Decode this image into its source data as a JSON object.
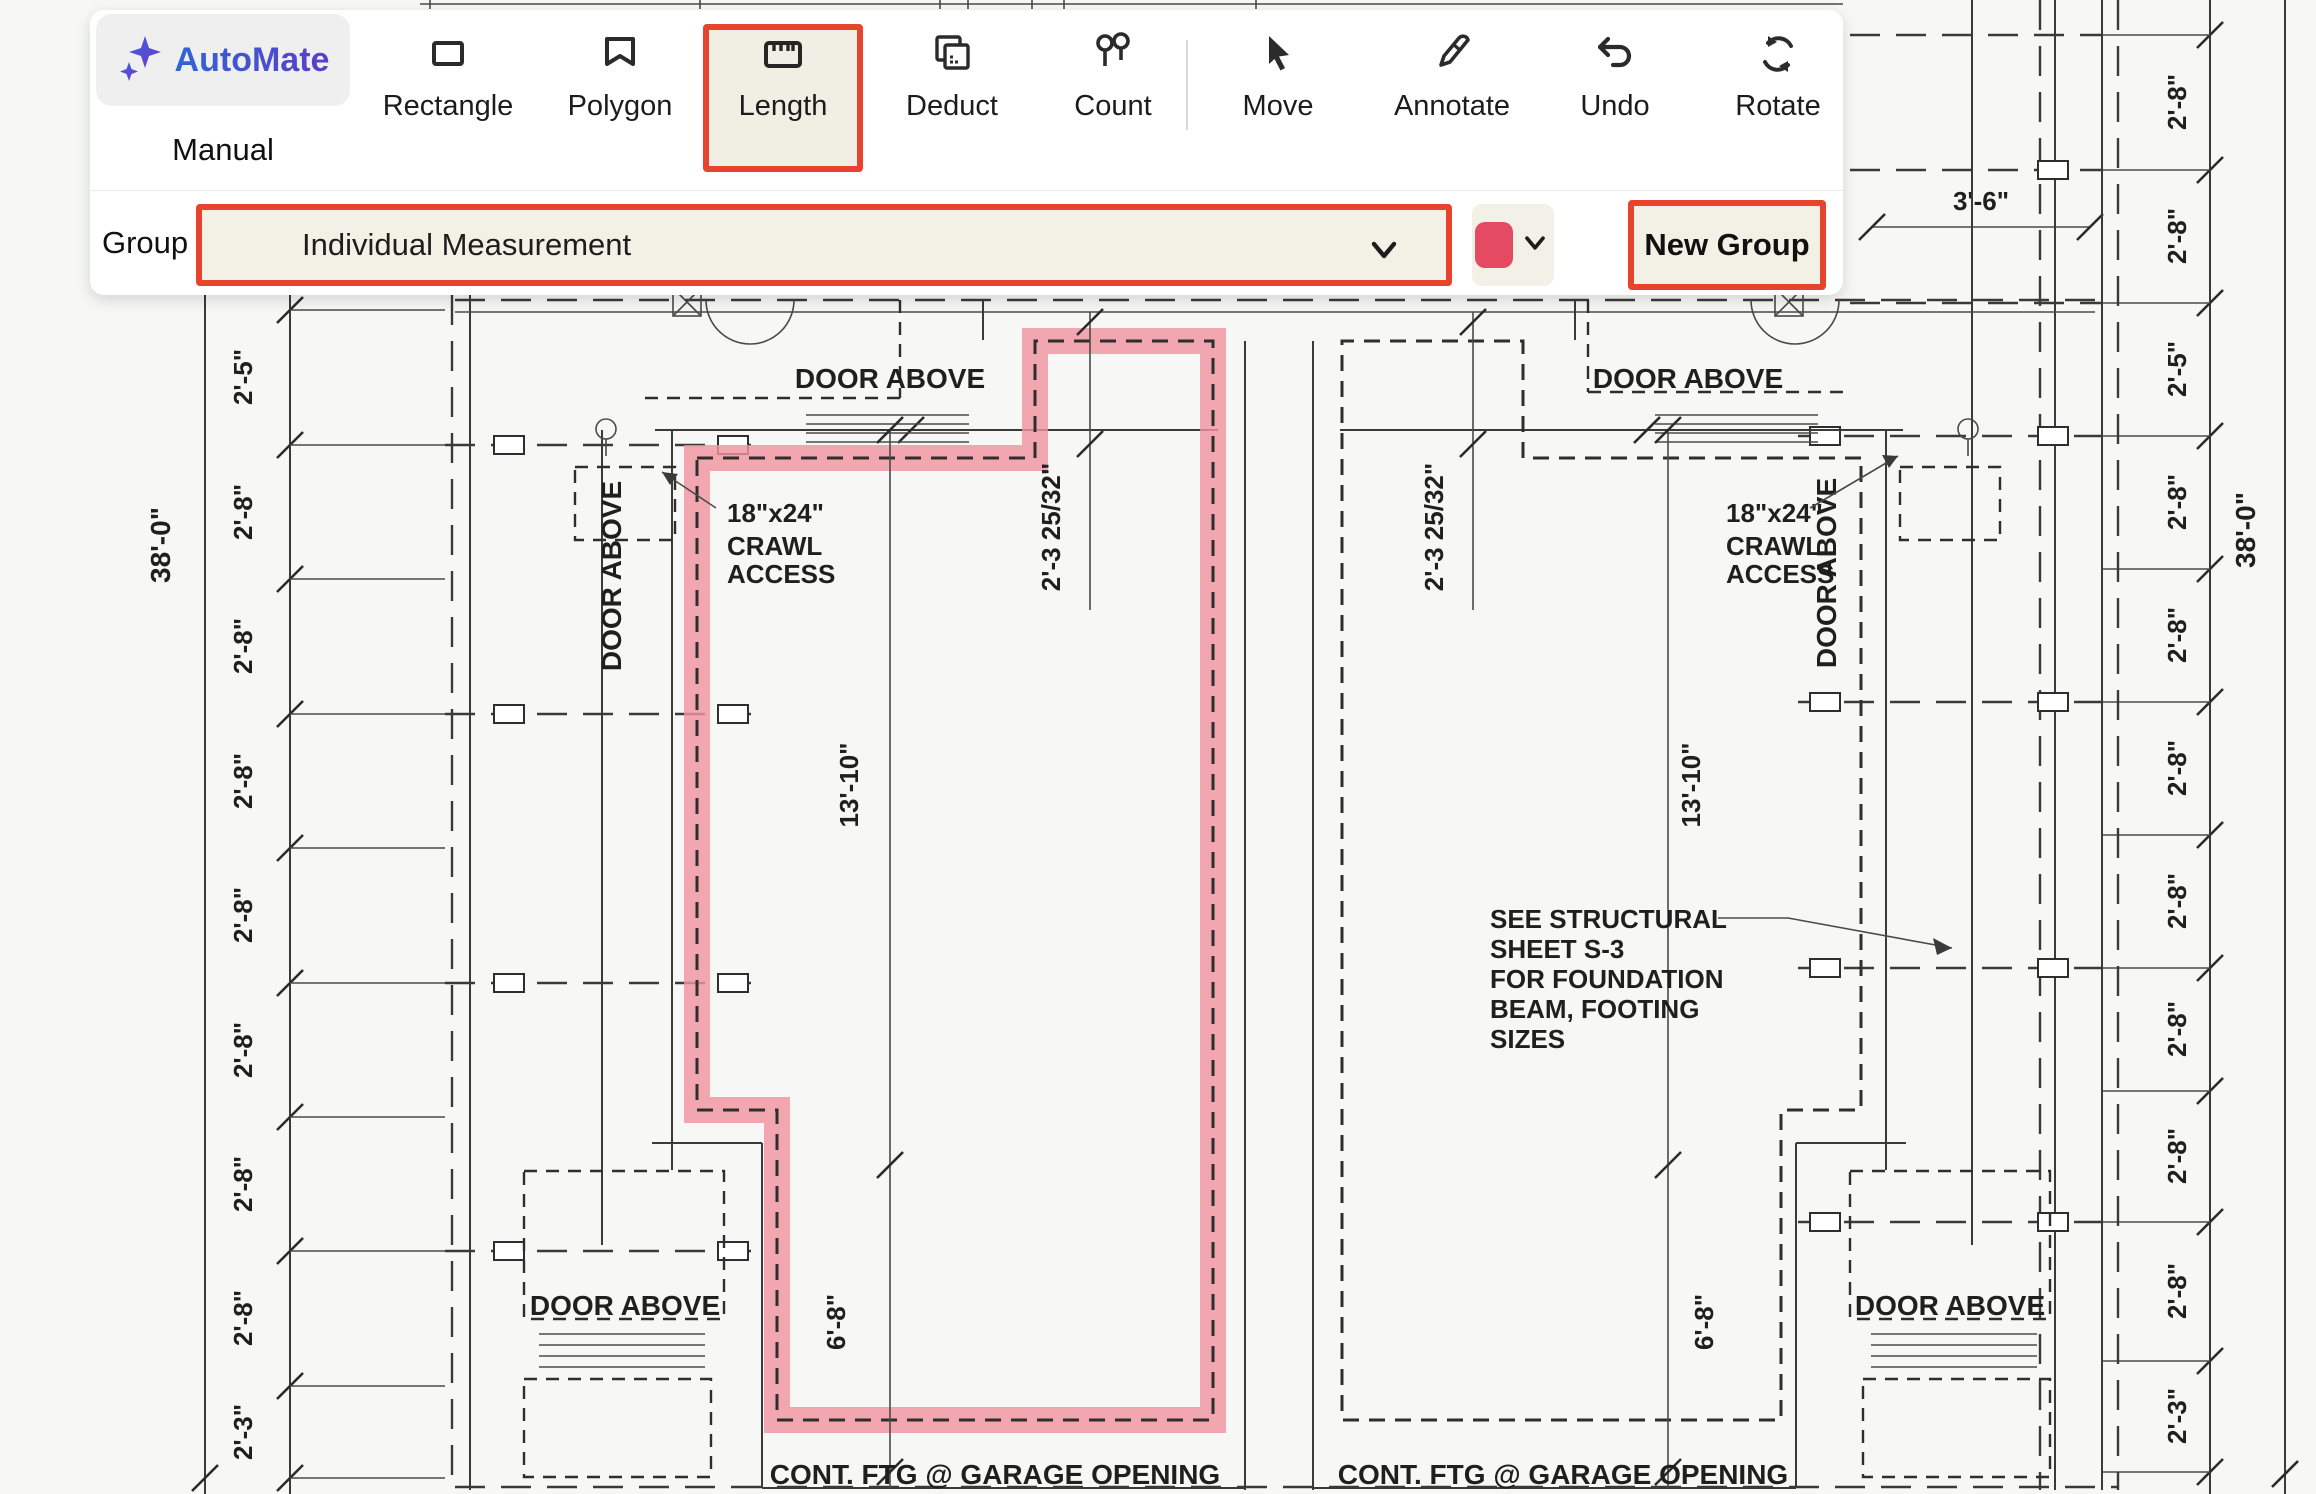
{
  "toolbar": {
    "automate_label": "AutoMate",
    "manual_label": "Manual",
    "tools": [
      {
        "name": "rectangle",
        "label": "Rectangle"
      },
      {
        "name": "polygon",
        "label": "Polygon"
      },
      {
        "name": "length",
        "label": "Length"
      },
      {
        "name": "deduct",
        "label": "Deduct"
      },
      {
        "name": "count",
        "label": "Count"
      },
      {
        "name": "move",
        "label": "Move"
      },
      {
        "name": "annotate",
        "label": "Annotate"
      },
      {
        "name": "undo",
        "label": "Undo"
      },
      {
        "name": "rotate",
        "label": "Rotate"
      }
    ],
    "selected_tool": "Length",
    "group_label": "Group",
    "group_value": "Individual Measurement",
    "new_group_label": "New Group",
    "accent_color": "#e8432c",
    "swatch_color": "#e44b62"
  },
  "plan": {
    "door_above": "DOOR ABOVE",
    "crawl_line1": "18\"x24\"",
    "crawl_line2": "CRAWL",
    "crawl_line3": "ACCESS",
    "cont_ftg": "CONT. FTG @ GARAGE OPENING",
    "note_line1": "SEE STRUCTURAL",
    "note_line2": "SHEET S-3",
    "note_line3": "FOR FOUNDATION",
    "note_line4": "BEAM, FOOTING",
    "note_line5": "SIZES",
    "overall_dim": "38'-0\"",
    "dim_3_6": "3'-6\"",
    "dim_2_3_25_32": "2'-3 25/32\"",
    "dim_13_10": "13'-10\"",
    "dim_6_8": "6'-8\"",
    "left_chain": [
      "2'-5\"",
      "2'-8\"",
      "2'-8\"",
      "2'-8\"",
      "2'-8\"",
      "2'-8\"",
      "2'-8\"",
      "2'-8\"",
      "2'-3\""
    ],
    "right_chain": [
      "2'-8\"",
      "2'-8\"",
      "2'-5\"",
      "2'-8\"",
      "2'-8\"",
      "2'-8\"",
      "2'-8\"",
      "2'-8\"",
      "2'-8\"",
      "2'-8\"",
      "2'-3\""
    ],
    "highlight_color": "rgba(240,148,160,0.82)"
  }
}
